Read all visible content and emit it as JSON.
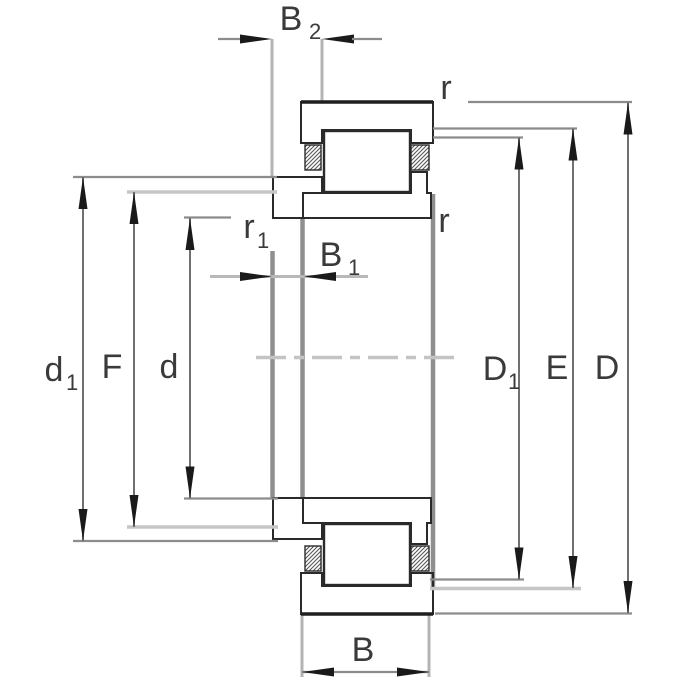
{
  "drawing_title": "Cylindrical roller bearing with angle ring - dimension drawing",
  "labels": {
    "b2": {
      "main": "B",
      "sub": "2"
    },
    "b1": {
      "main": "B",
      "sub": "1"
    },
    "b": {
      "main": "B",
      "sub": ""
    },
    "r_top_right": {
      "main": "r",
      "sub": ""
    },
    "r_mid_right": {
      "main": "r",
      "sub": ""
    },
    "r1": {
      "main": "r",
      "sub": "1"
    },
    "d1": {
      "main": "d",
      "sub": "1"
    },
    "f": {
      "main": "F",
      "sub": ""
    },
    "d": {
      "main": "d",
      "sub": ""
    },
    "D1": {
      "main": "D",
      "sub": "1"
    },
    "e": {
      "main": "E",
      "sub": ""
    },
    "D": {
      "main": "D",
      "sub": ""
    }
  },
  "colors": {
    "background": "#ffffff",
    "outline": "#2a2a2a",
    "hatch": "#3d3d3d",
    "dimension_line": "#707070",
    "extension_line": "#8c8c8c",
    "light_line": "#c6c6c6",
    "projection_line": "#8f8f8f",
    "arrow": "#1a1a1a",
    "label_text": "#3a3a3a"
  }
}
